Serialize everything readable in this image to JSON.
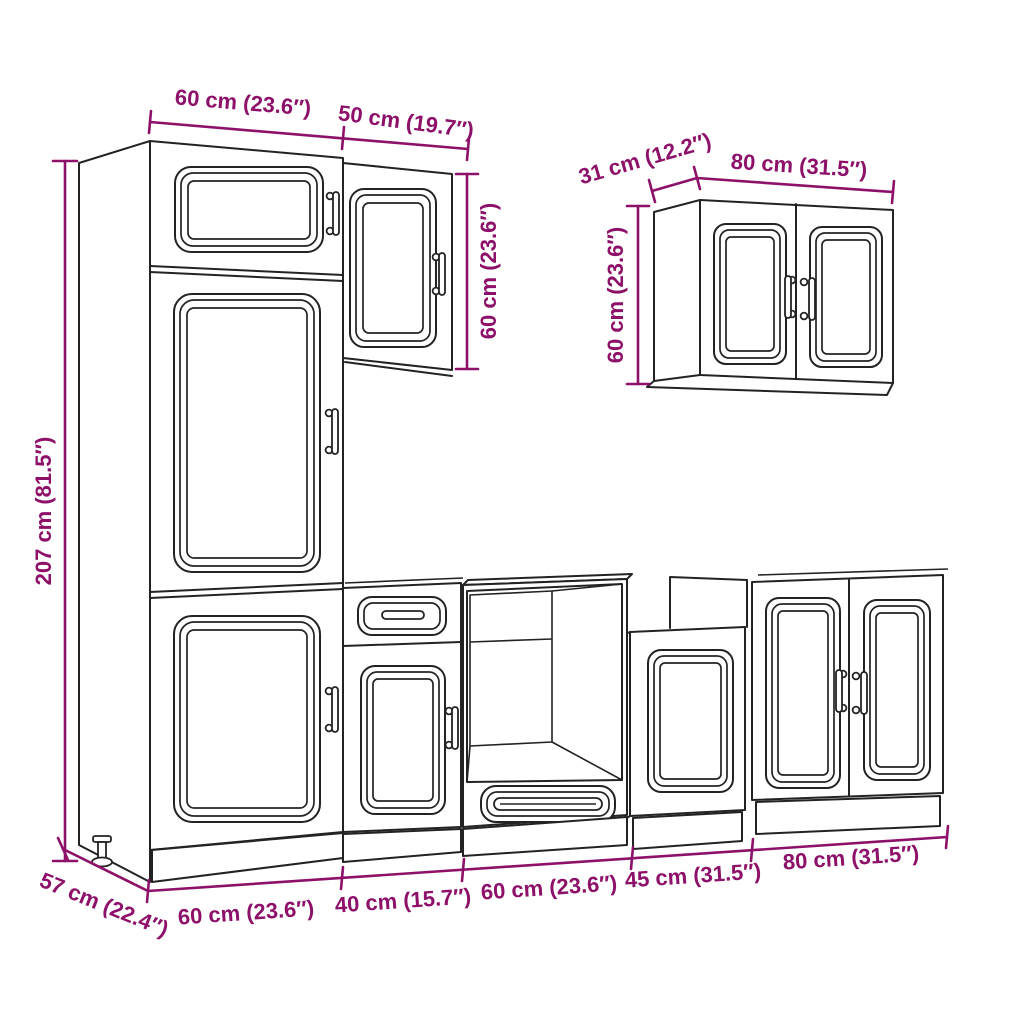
{
  "diagram": {
    "title": "kitchen cabinet set dimension drawing",
    "background_color": "#ffffff",
    "line_color": "#232323",
    "dimension_color": "#8d1169",
    "dimensions": {
      "tall_cabinet_width": "60 cm (23.6″)",
      "upper_cabinet_width": "50 cm (19.7″)",
      "upper_cabinet_height": "60 cm (23.6″)",
      "wall_cabinet_depth": "31 cm (12.2″)",
      "wall_cabinet_width": "80 cm (31.5″)",
      "wall_cabinet_height": "60 cm (23.6″)",
      "tall_cabinet_height": "207 cm (81.5″)",
      "tall_cabinet_depth": "57 cm (22.4″)",
      "base_tall_unit_width": "60 cm (23.6″)",
      "base_drawer_unit_width": "40 cm (15.7″)",
      "base_oven_unit_width": "60 cm (23.6″)",
      "base_45_unit_width": "45 cm (31.5″)",
      "base_double_unit_width": "80 cm (31.5″)"
    }
  }
}
